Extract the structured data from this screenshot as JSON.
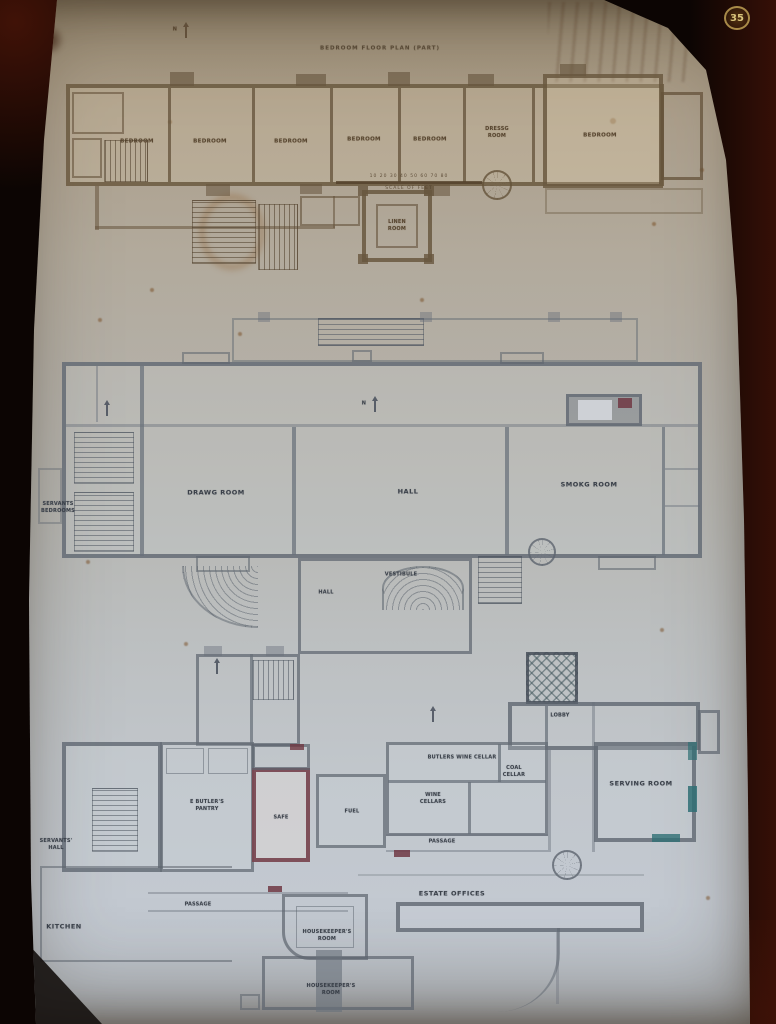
{
  "colors": {
    "frame_dark": "#0c0503",
    "paper_warm": "#a89983",
    "paper_cool": "#c2c8d0",
    "ink_sepia": "#52412c",
    "ink_gray": "#49525c",
    "accent_maroon": "#703844",
    "accent_teal": "#2f6f74",
    "badge_gold": "#d9c47c"
  },
  "badge": {
    "number": "35"
  },
  "bedroom_floor": {
    "title": "BEDROOM FLOOR PLAN (PART)",
    "labels": {
      "bedroom_1": "BEDROOM",
      "bedroom_2": "BEDROOM",
      "bedroom_3": "BEDROOM",
      "bedroom_4": "BEDROOM",
      "bedroom_5": "BEDROOM",
      "bedroom_6": "BEDROOM",
      "dressing_room_line1": "DRESSG",
      "dressing_room_line2": "ROOM",
      "linen_room_line1": "LINEN",
      "linen_room_line2": "ROOM",
      "north": "N"
    },
    "scale_bar": {
      "numbers": "10 20 30 40 50 60 70 80",
      "caption": "SCALE OF FEET"
    }
  },
  "principal_floor": {
    "labels": {
      "servants_bedrooms_line1": "SERVANTS",
      "servants_bedrooms_line2": "BEDROOMS",
      "drawing_room": "DRAWG  ROOM",
      "hall": "HALL",
      "smoking_room": "SMOKG ROOM",
      "vestibule": "VESTIBULE",
      "hall_lower": "HALL",
      "north": "N"
    }
  },
  "ground_floor": {
    "labels": {
      "lobby": "LOBBY",
      "serving_room": "SERVING ROOM",
      "butlers_pantry_line1": "E BUTLER'S",
      "butlers_pantry_line2": "PANTRY",
      "safe": "SAFE",
      "fuel": "FUEL",
      "butlers_wine_cellar": "BUTLERS WINE CELLAR",
      "wine_cellars_line1": "WINE",
      "wine_cellars_line2": "CELLARS",
      "coal_cellar_line1": "COAL",
      "coal_cellar_line2": "CELLAR",
      "passage_center": "PASSAGE",
      "estate_offices": "ESTATE OFFICES",
      "housekeepers_room_line1": "HOUSEKEEPER'S",
      "housekeepers_room_line2": "ROOM",
      "housekeepers_room2_line1": "HOUSEKEEPER'S",
      "housekeepers_room2_line2": "ROOM",
      "servants_hall_line1": "SERVANTS'",
      "servants_hall_line2": "HALL",
      "kitchen": "KITCHEN",
      "passage_left": "PASSAGE",
      "north": "N"
    }
  }
}
